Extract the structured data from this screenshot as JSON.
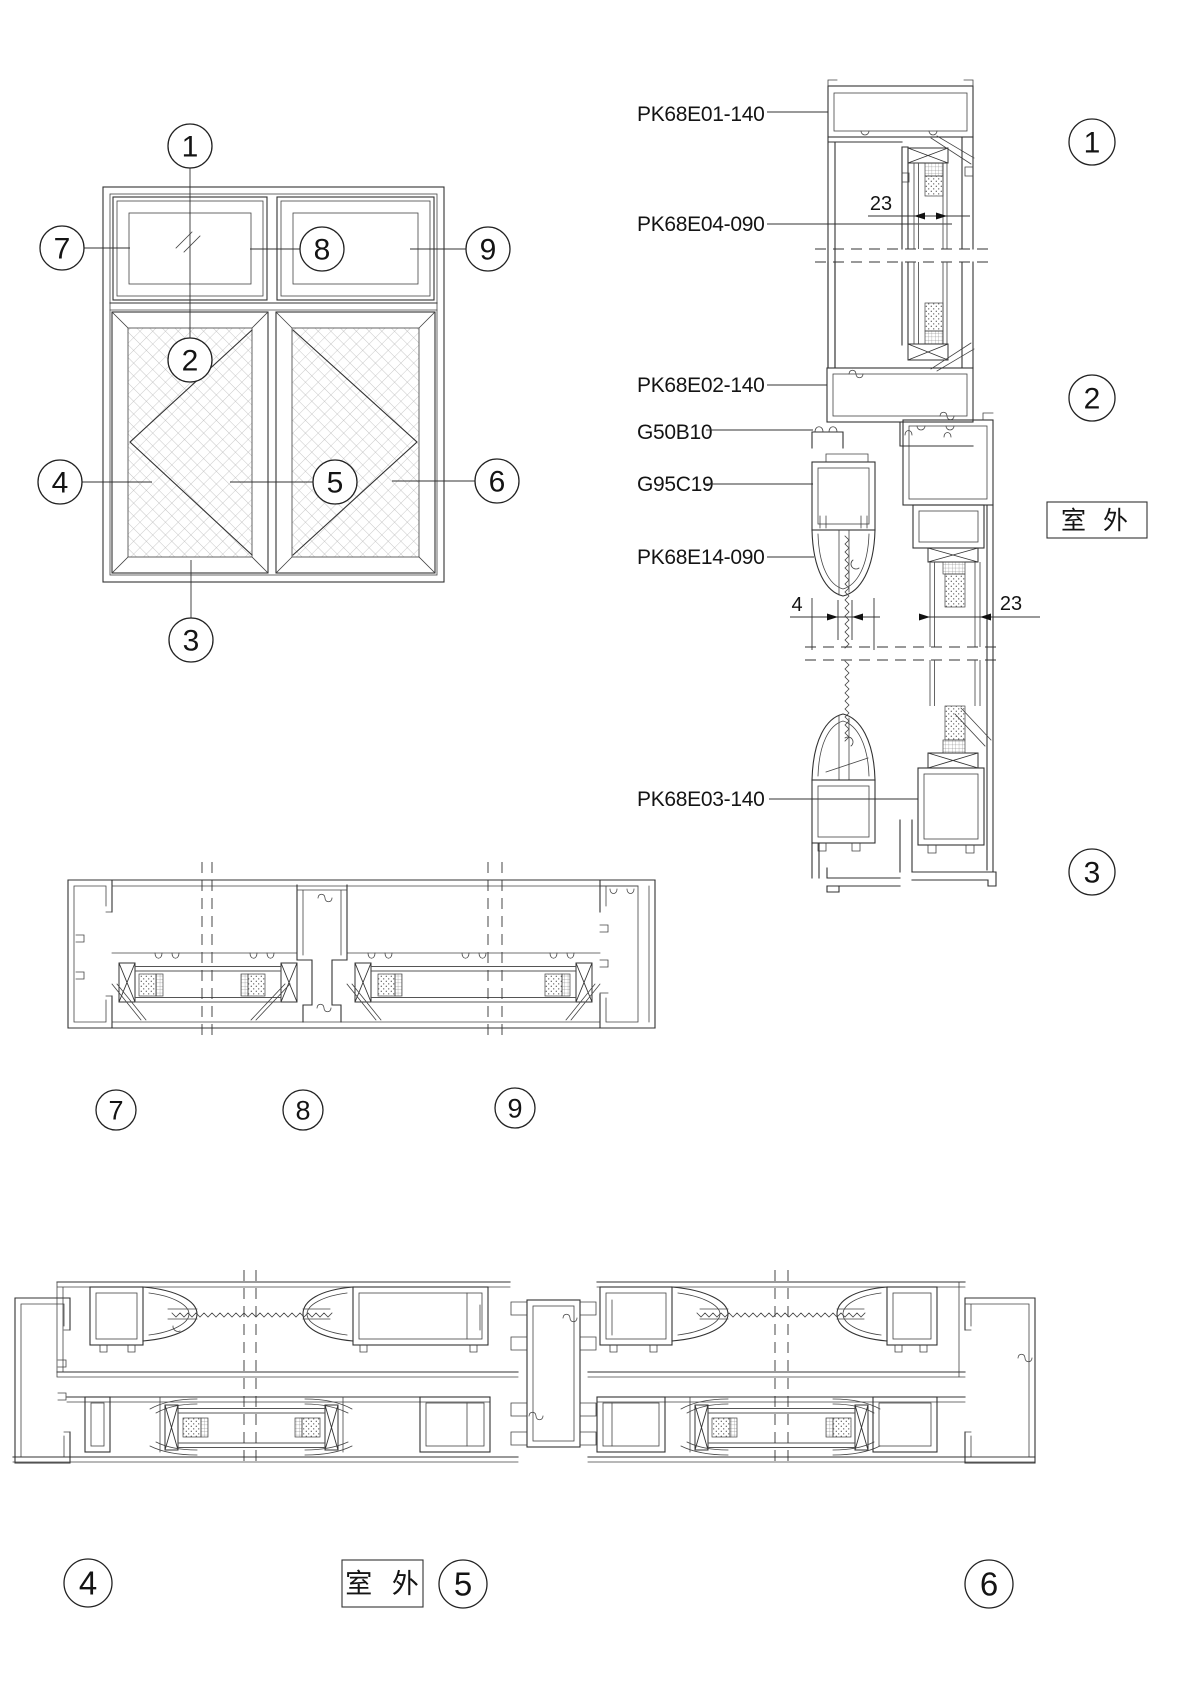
{
  "drawing_title": "aluminum window elevation and section details",
  "parts": [
    {
      "label": "PK68E01-140"
    },
    {
      "label": "PK68E04-090"
    },
    {
      "label": "PK68E02-140"
    },
    {
      "label": "G50B10"
    },
    {
      "label": "G95C19"
    },
    {
      "label": "PK68E14-090"
    },
    {
      "label": "PK68E03-140"
    }
  ],
  "dimensions": {
    "glass_top": "23",
    "seal_gap": "4",
    "glass_bottom": "23"
  },
  "location_labels": {
    "outdoor_right": "室 外",
    "outdoor_bottom": "室 外"
  },
  "callouts": {
    "elevation": [
      "1",
      "2",
      "3",
      "4",
      "5",
      "6",
      "7",
      "8",
      "9"
    ],
    "vertical_section": [
      "1",
      "2",
      "3"
    ],
    "top_horizontal_section": [
      "7",
      "8",
      "9"
    ],
    "bottom_horizontal_section": [
      "4",
      "5",
      "6"
    ]
  }
}
